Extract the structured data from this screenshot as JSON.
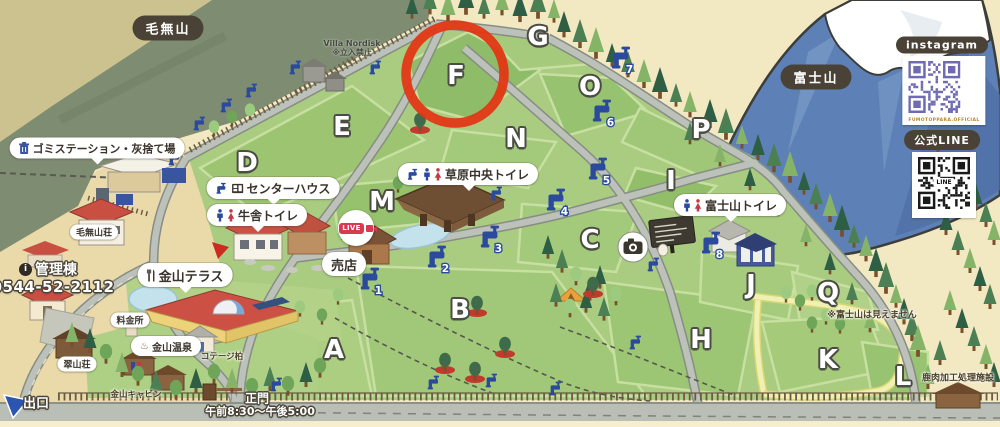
{
  "landmarks": {
    "mountain_left": "毛無山",
    "fuji": "富士山"
  },
  "social": {
    "instagram_label": "instagram",
    "instagram_caption": "FUMOTOPPARA.OFFICIAL",
    "line_label": "公式LINE",
    "line_logo": "LINE"
  },
  "live_label": "LIVE",
  "highlight_area": "F",
  "labels": {
    "garbage": "ゴミステーション・灰捨て場",
    "center_house": "センターハウス",
    "cowshed_toilet": "牛舎トイレ",
    "grass_toilet": "草原中央トイレ",
    "fuji_toilet": "富士山トイレ",
    "terrace": "金山テラス",
    "onsen": "金山温泉",
    "shop": "売店",
    "fee": "料金所",
    "kenashi_sou": "毛無山荘",
    "suizan_sou": "翠山荘",
    "cottage": "コテージ柏",
    "cabin": "金山キャビン",
    "villa": "Villa Nordisk",
    "villa_note": "※立入禁止",
    "no_fuji": "※富士山は見えません",
    "deer": "鹿肉加工処理施設",
    "admin": "管理棟",
    "phone": "0544-52-2112",
    "exit": "出口",
    "gate": "正門",
    "hours": "午前8:30〜午後5:00"
  },
  "areas": [
    {
      "label": "A",
      "x": 334,
      "y": 350
    },
    {
      "label": "B",
      "x": 460,
      "y": 310
    },
    {
      "label": "C",
      "x": 590,
      "y": 240
    },
    {
      "label": "D",
      "x": 247,
      "y": 163
    },
    {
      "label": "E",
      "x": 342,
      "y": 127
    },
    {
      "label": "F",
      "x": 456,
      "y": 76
    },
    {
      "label": "G",
      "x": 538,
      "y": 37
    },
    {
      "label": "H",
      "x": 701,
      "y": 340
    },
    {
      "label": "I",
      "x": 671,
      "y": 181
    },
    {
      "label": "J",
      "x": 751,
      "y": 285
    },
    {
      "label": "K",
      "x": 828,
      "y": 360
    },
    {
      "label": "L",
      "x": 903,
      "y": 377
    },
    {
      "label": "M",
      "x": 382,
      "y": 202
    },
    {
      "label": "N",
      "x": 516,
      "y": 139
    },
    {
      "label": "O",
      "x": 590,
      "y": 87
    },
    {
      "label": "P",
      "x": 701,
      "y": 130
    },
    {
      "label": "Q",
      "x": 828,
      "y": 293
    }
  ],
  "taps": [
    {
      "n": "1",
      "x": 371,
      "y": 283
    },
    {
      "n": "2",
      "x": 438,
      "y": 261
    },
    {
      "n": "3",
      "x": 491,
      "y": 241
    },
    {
      "n": "4",
      "x": 557,
      "y": 204
    },
    {
      "n": "5",
      "x": 599,
      "y": 173
    },
    {
      "n": "6",
      "x": 603,
      "y": 115
    },
    {
      "n": "7",
      "x": 622,
      "y": 62
    },
    {
      "n": "8",
      "x": 712,
      "y": 247
    }
  ],
  "taps_plain": [
    [
      296,
      71
    ],
    [
      376,
      71
    ],
    [
      252,
      94
    ],
    [
      227,
      109
    ],
    [
      200,
      127
    ],
    [
      175,
      162
    ],
    [
      497,
      197
    ],
    [
      434,
      386
    ],
    [
      492,
      384
    ],
    [
      556,
      392
    ],
    [
      636,
      346
    ],
    [
      654,
      268
    ],
    [
      277,
      388
    ]
  ]
}
